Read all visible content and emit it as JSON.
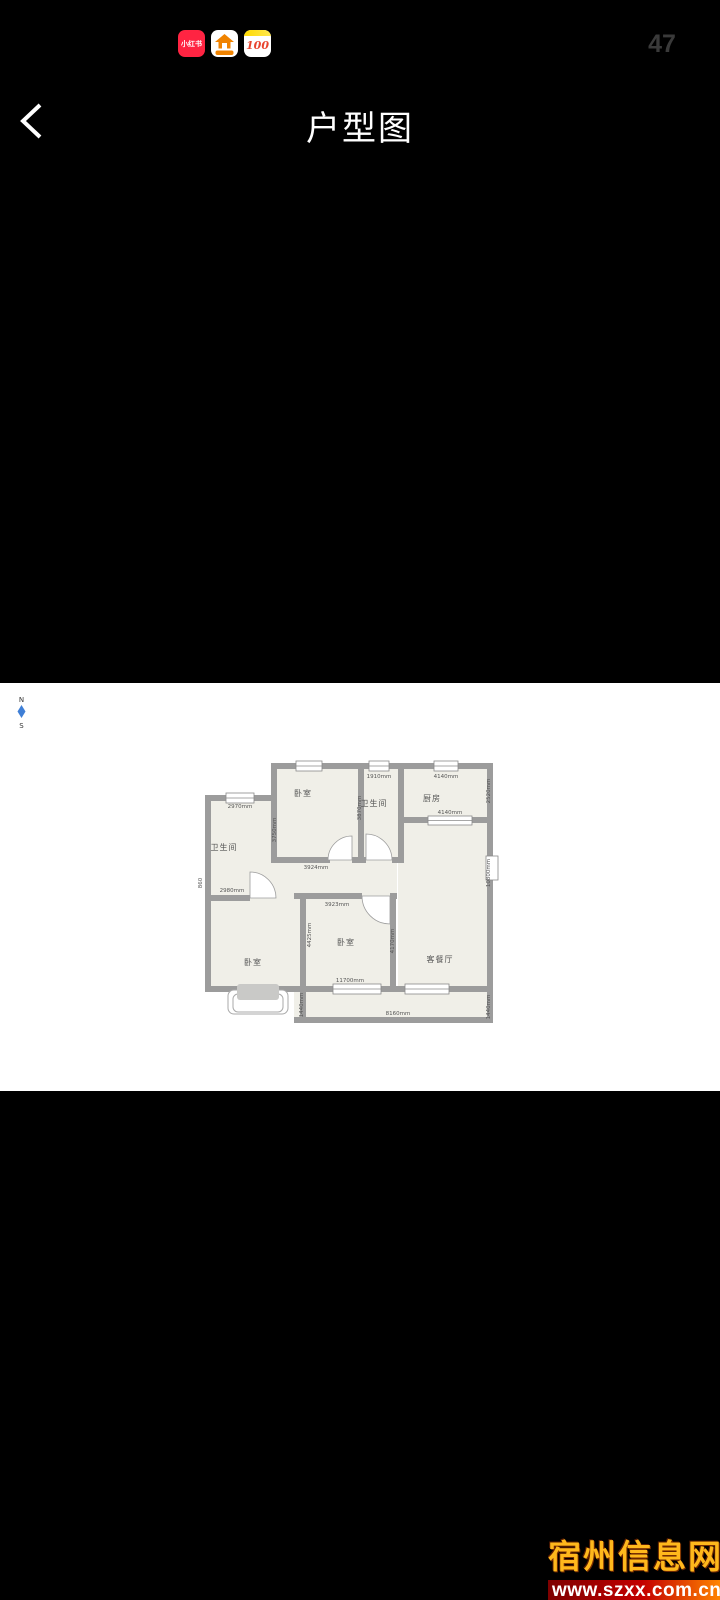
{
  "status_bar": {
    "apps": [
      {
        "name": "xiaohongshu",
        "label": "小红书"
      },
      {
        "name": "house-app",
        "label": ""
      },
      {
        "name": "100-app",
        "label": "100"
      }
    ],
    "badge_count": "47"
  },
  "header": {
    "title": "户型图"
  },
  "compass": {
    "north": "N",
    "south": "S"
  },
  "floor_plan": {
    "rooms": {
      "bedroom_top": "卧室",
      "bathroom_top": "卫生间",
      "kitchen": "厨房",
      "bathroom_left": "卫生间",
      "bedroom_left": "卧室",
      "bedroom_middle": "卧室",
      "living_dining": "客餐厅"
    },
    "dims": {
      "bathroom_left_window": "2970mm",
      "bedroom_top_depth": "3750mm",
      "bedroom_top_width": "3924mm",
      "bathroom_top_window": "1910mm",
      "bathroom_top_depth": "3870mm",
      "kitchen_window": "4140mm",
      "kitchen_depth": "2520mm",
      "kitchen_passthrough": "4140mm",
      "living_depth": "10800mm",
      "hall_left": "2980mm",
      "left_wall": "860",
      "bedroom_middle_top": "3923mm",
      "bedroom_middle_left": "4425mm",
      "bedroom_middle_right": "4170mm",
      "bedroom_middle_window": "11700mm",
      "balcony_width": "8160mm",
      "balcony_left": "1440mm",
      "balcony_right": "1440mm"
    }
  },
  "watermark": {
    "site_name": "宿州信息网",
    "url": "www.szxx.com.cn"
  },
  "colors": {
    "floor": "#f0efe8",
    "wall": "#9c9c9c",
    "accent_red": "#ff2442",
    "watermark_gold": "#ffb81c"
  }
}
